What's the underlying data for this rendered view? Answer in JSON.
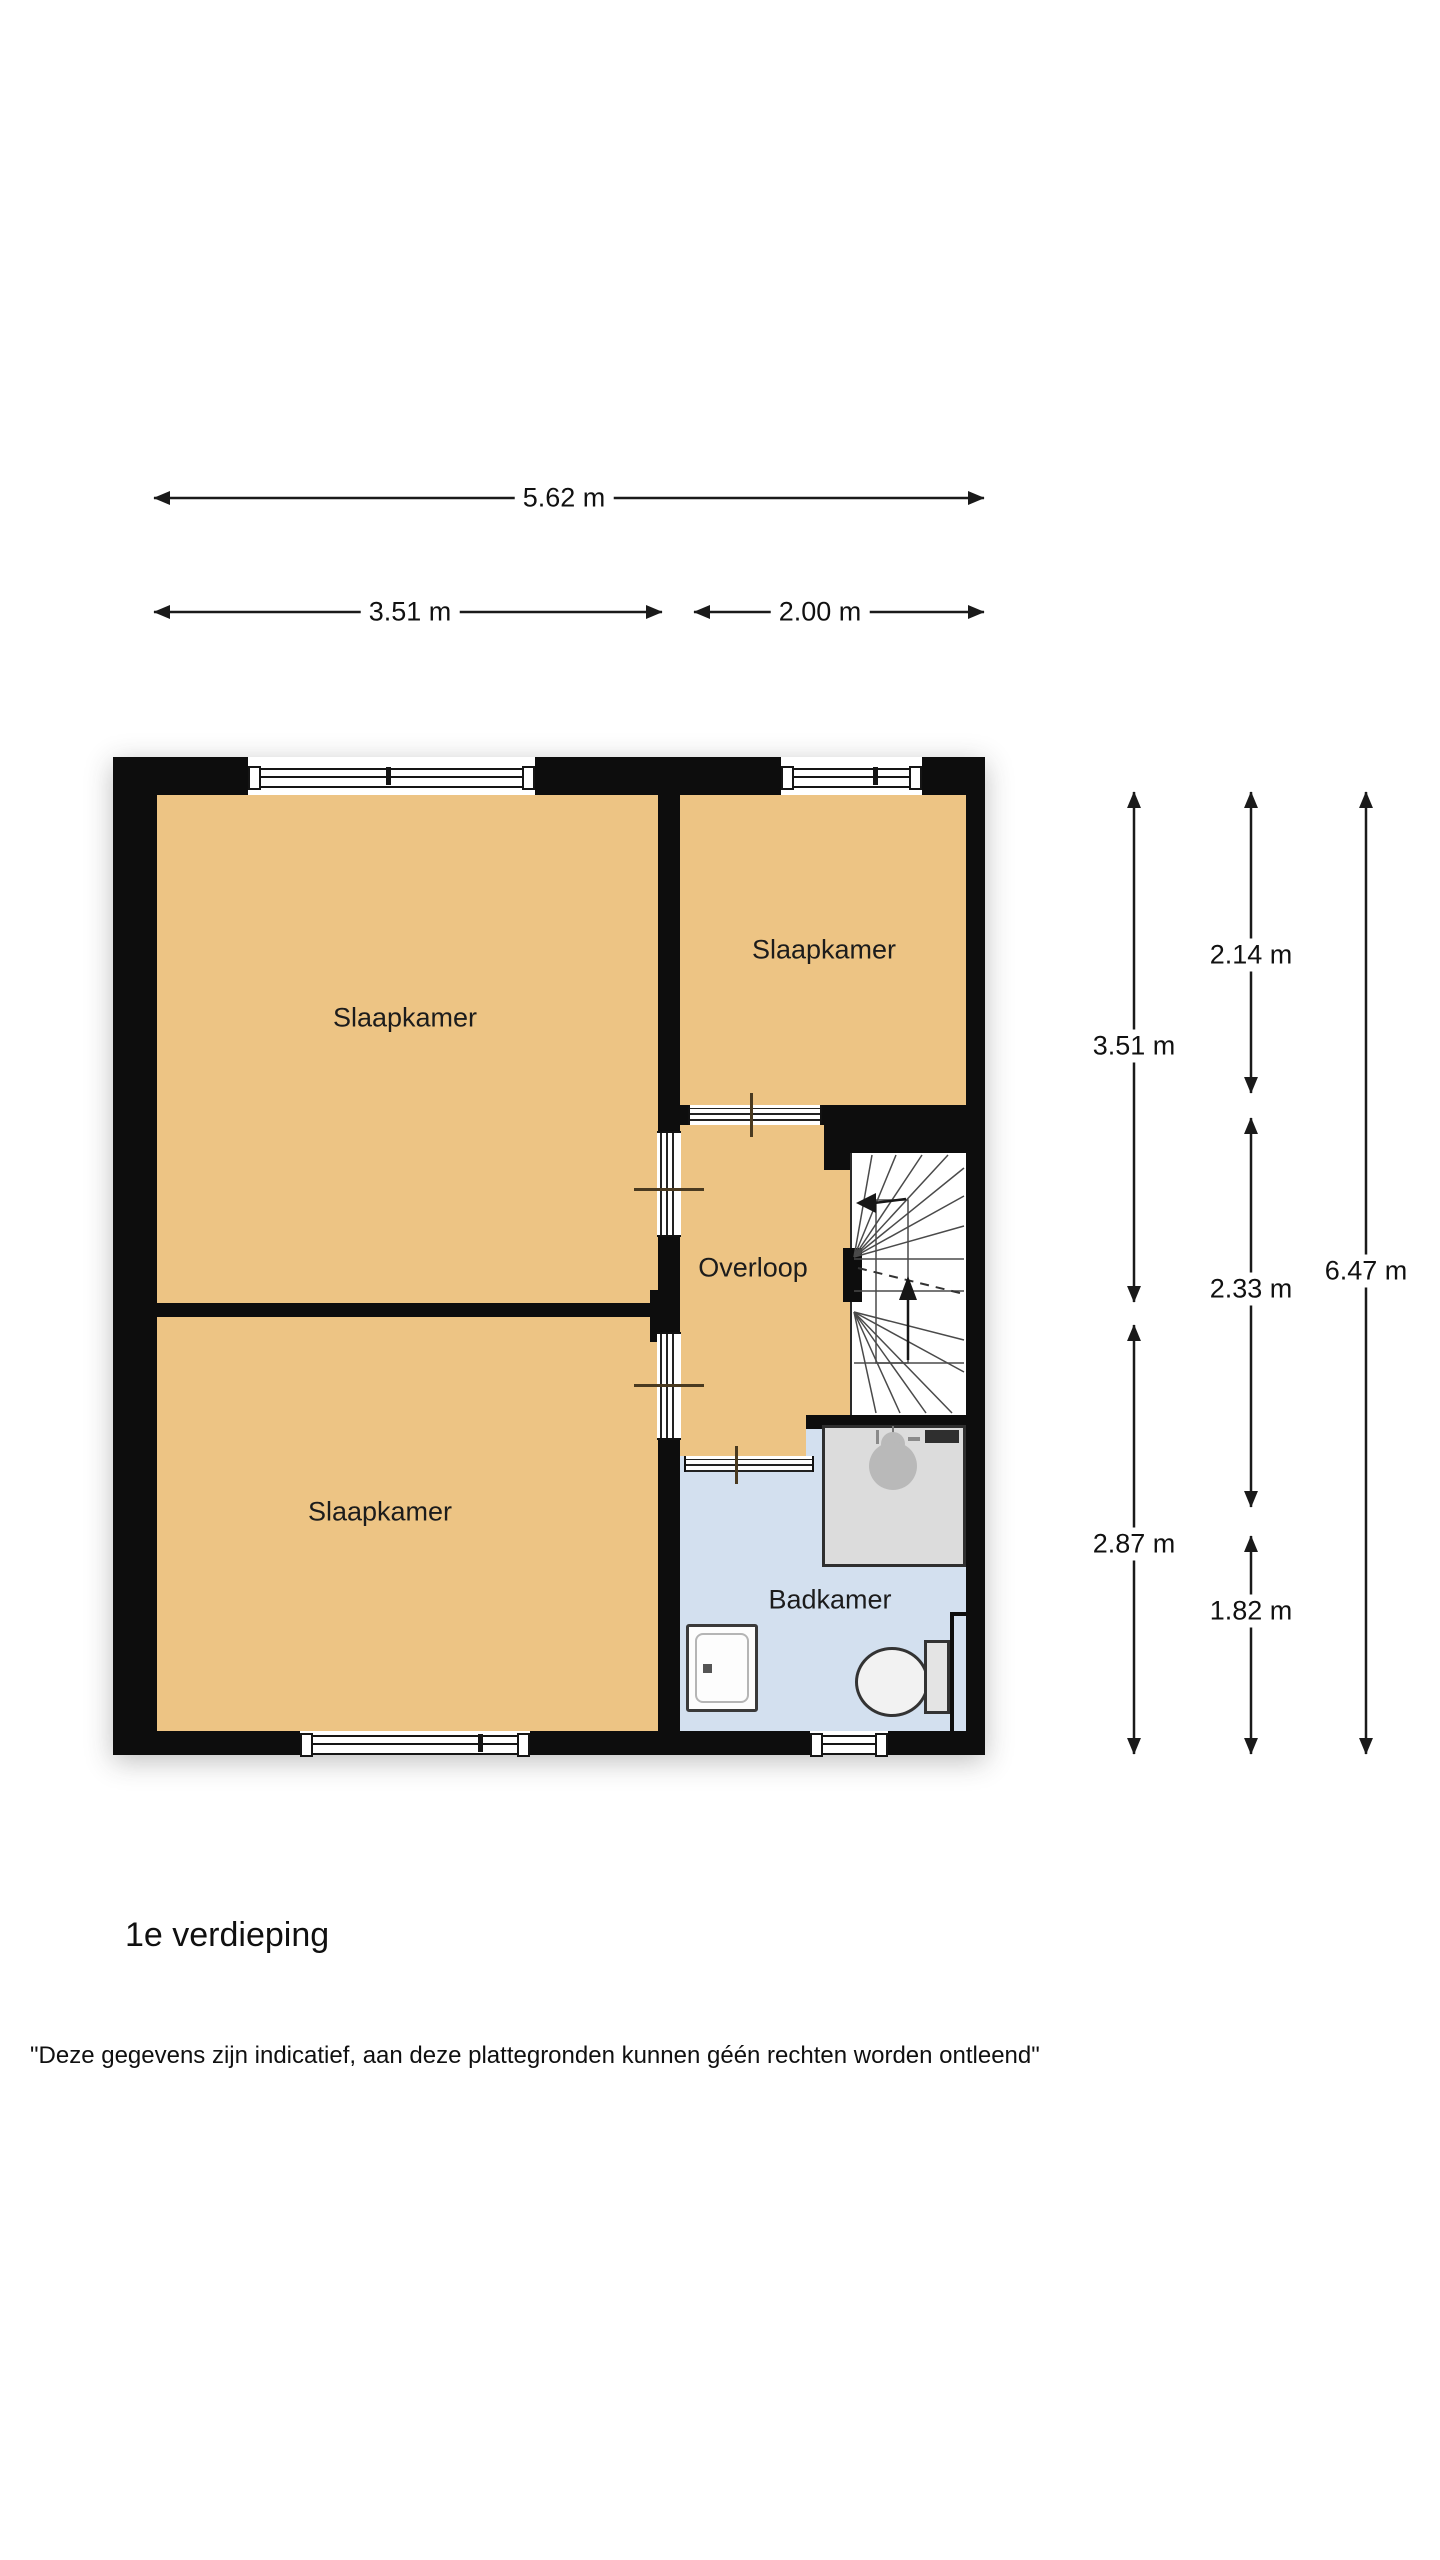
{
  "title": {
    "floor_label": "1e verdieping"
  },
  "disclaimer": "\"Deze gegevens zijn indicatief, aan deze plattegronden kunnen géén rechten worden ontleend\"",
  "rooms": {
    "bedroom_top_left": "Slaapkamer",
    "bedroom_top_right": "Slaapkamer",
    "bedroom_bottom_left": "Slaapkamer",
    "landing": "Overloop",
    "bathroom": "Badkamer"
  },
  "dimensions_top": {
    "total_width": "5.62 m",
    "left_width": "3.51 m",
    "right_width": "2.00 m"
  },
  "dimensions_right": {
    "inner_left_top": "3.51 m",
    "inner_left_bottom": "2.87 m",
    "inner_mid_top": "2.14 m",
    "inner_mid_middle": "2.33 m",
    "inner_mid_bottom": "1.82 m",
    "outer_total": "6.47 m"
  },
  "colors": {
    "room-fill": "#edc484",
    "bathroom-fill": "#d3e0ef",
    "wall": "#0d0d0d",
    "shower-fill": "#dcdcdc"
  }
}
